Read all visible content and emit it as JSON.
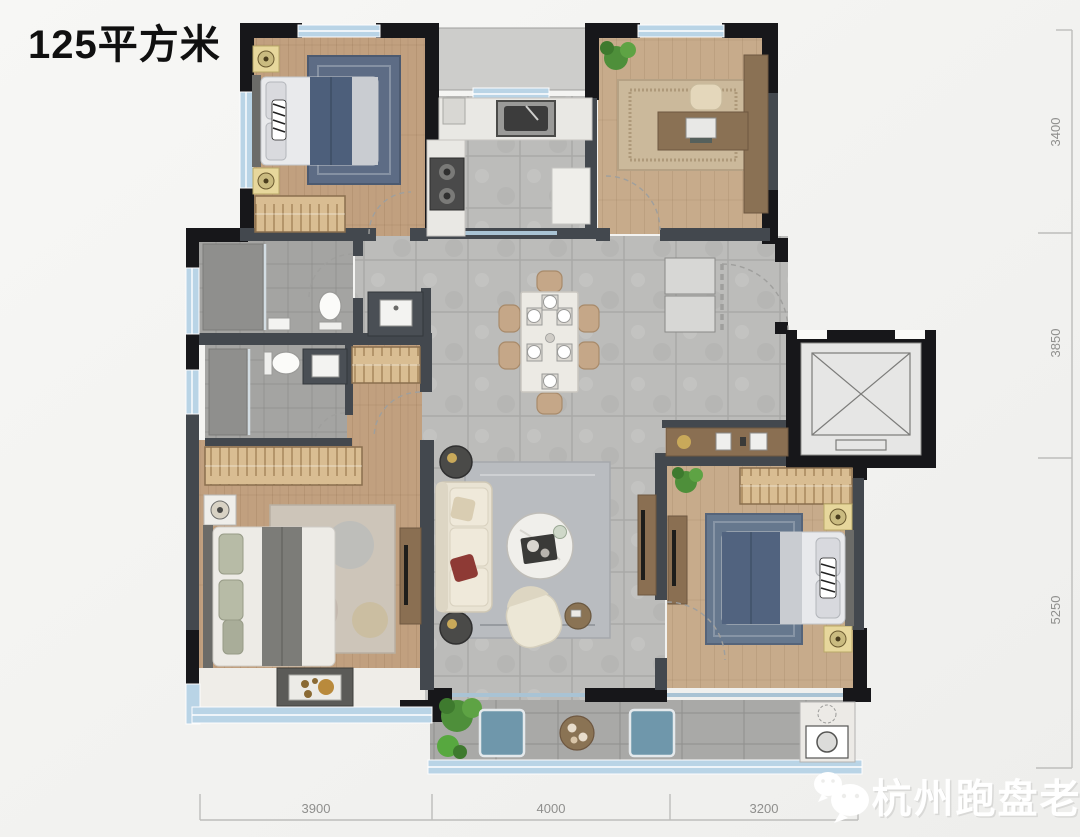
{
  "title": "125平方米",
  "dimensions": {
    "right": [
      "3400",
      "3850",
      "5250"
    ],
    "bottom": [
      "3900",
      "4000",
      "3200"
    ]
  },
  "watermark": {
    "name": "杭州跑盘老司机",
    "icon": "wechat-icon"
  },
  "colors": {
    "background": "#f2f2f0",
    "exterior_wall": "#17171a",
    "interior_wall": "#43484e",
    "window_glass": "#b9d4e6",
    "wood_floor_warm": "#c1a07f",
    "wood_floor_light": "#c7ab8b",
    "hall_tile": "#bcbcba",
    "bath_tile": "#a4a4a2",
    "balcony_tile": "#a9a9a7",
    "wardrobe": "#d9bd92",
    "bedding_navy": "#4d5f7b",
    "sofa_cream": "#e9e3d3",
    "dimension_line": "#bdbdbb",
    "dimension_text": "#8f8f8d",
    "watermark_text": "#ffffff"
  }
}
